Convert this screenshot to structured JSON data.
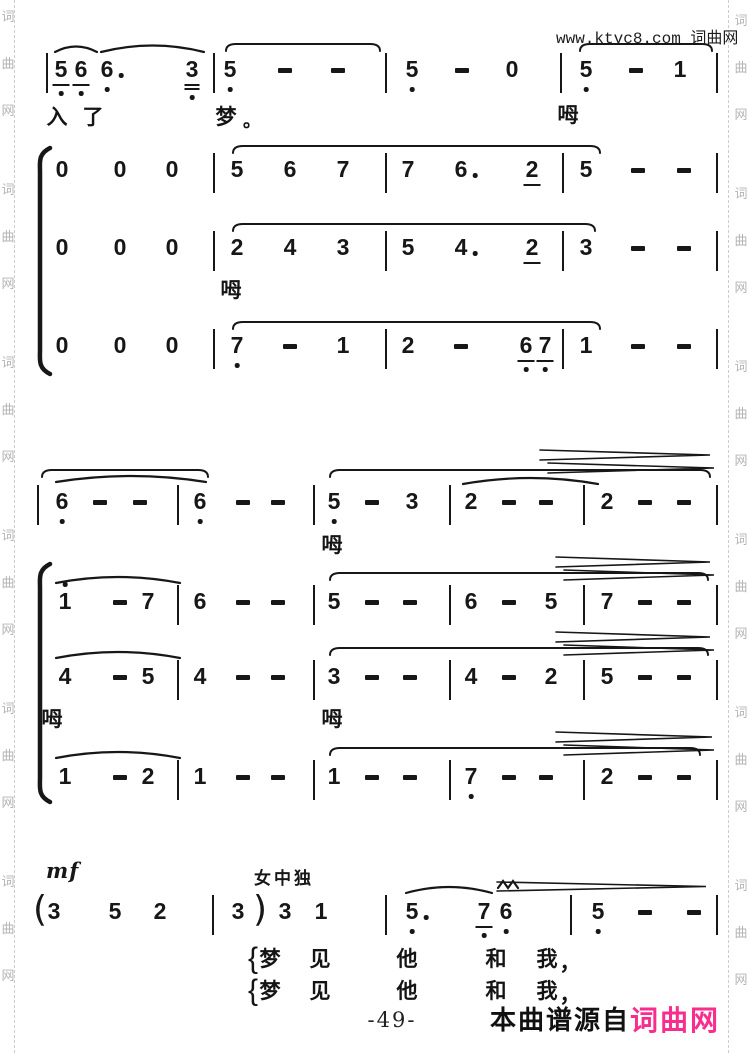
{
  "meta": {
    "watermark_top": "www.ktvc8.com 词曲网",
    "page_number": "-49-",
    "footer_prefix": "本曲谱源自",
    "footer_brand": "词曲网",
    "side_chars": [
      "词",
      "曲",
      "网"
    ],
    "colors": {
      "ink": "#171717",
      "gray_watermark": "#b4b4b4",
      "brand_pink": "#f72e8e",
      "paper": "#ffffff"
    }
  },
  "labels": {
    "mf": "mf",
    "solo": "女中独"
  },
  "score": {
    "rows": [
      {
        "name": "solo-line-1",
        "y": 58,
        "tokens": [
          {
            "t": "|",
            "x": 46
          },
          {
            "t": "5",
            "x": 61,
            "u": 1,
            "lo": 1
          },
          {
            "t": "6",
            "x": 81,
            "u": 1,
            "lo": 1
          },
          {
            "t": "6",
            "x": 107,
            "aug": true,
            "lo": 1
          },
          {
            "t": "3",
            "x": 192,
            "u": 2,
            "lo": 1
          },
          {
            "t": "|",
            "x": 213
          },
          {
            "t": "5",
            "x": 230,
            "lo": 1
          },
          {
            "t": "-",
            "x": 285
          },
          {
            "t": "-",
            "x": 338
          },
          {
            "t": "|",
            "x": 385
          },
          {
            "t": "5",
            "x": 412,
            "lo": 1
          },
          {
            "t": "-",
            "x": 462
          },
          {
            "t": "0",
            "x": 512
          },
          {
            "t": "|",
            "x": 560
          },
          {
            "t": "5",
            "x": 586,
            "lo": 1
          },
          {
            "t": "-",
            "x": 636
          },
          {
            "t": "1",
            "x": 680
          },
          {
            "t": "|",
            "x": 716
          }
        ]
      },
      {
        "name": "choir1-line-1",
        "y": 158,
        "tokens": [
          {
            "t": "0",
            "x": 62
          },
          {
            "t": "0",
            "x": 120
          },
          {
            "t": "0",
            "x": 172
          },
          {
            "t": "|",
            "x": 213
          },
          {
            "t": "5",
            "x": 237
          },
          {
            "t": "6",
            "x": 290
          },
          {
            "t": "7",
            "x": 343
          },
          {
            "t": "|",
            "x": 385
          },
          {
            "t": "7",
            "x": 408
          },
          {
            "t": "6",
            "x": 461,
            "aug": true
          },
          {
            "t": "2",
            "x": 532,
            "u": 1
          },
          {
            "t": "|",
            "x": 562
          },
          {
            "t": "5",
            "x": 586
          },
          {
            "t": "-",
            "x": 638
          },
          {
            "t": "-",
            "x": 684
          },
          {
            "t": "|",
            "x": 716
          }
        ]
      },
      {
        "name": "choir1-line-2",
        "y": 236,
        "tokens": [
          {
            "t": "0",
            "x": 62
          },
          {
            "t": "0",
            "x": 120
          },
          {
            "t": "0",
            "x": 172
          },
          {
            "t": "|",
            "x": 213
          },
          {
            "t": "2",
            "x": 237
          },
          {
            "t": "4",
            "x": 290
          },
          {
            "t": "3",
            "x": 343
          },
          {
            "t": "|",
            "x": 385
          },
          {
            "t": "5",
            "x": 408
          },
          {
            "t": "4",
            "x": 461,
            "aug": true
          },
          {
            "t": "2",
            "x": 532,
            "u": 1
          },
          {
            "t": "|",
            "x": 562
          },
          {
            "t": "3",
            "x": 586
          },
          {
            "t": "-",
            "x": 638
          },
          {
            "t": "-",
            "x": 684
          },
          {
            "t": "|",
            "x": 716
          }
        ]
      },
      {
        "name": "choir1-line-3",
        "y": 334,
        "tokens": [
          {
            "t": "0",
            "x": 62
          },
          {
            "t": "0",
            "x": 120
          },
          {
            "t": "0",
            "x": 172
          },
          {
            "t": "|",
            "x": 213
          },
          {
            "t": "7",
            "x": 237,
            "lo": 1
          },
          {
            "t": "-",
            "x": 290
          },
          {
            "t": "1",
            "x": 343
          },
          {
            "t": "|",
            "x": 385
          },
          {
            "t": "2",
            "x": 408
          },
          {
            "t": "-",
            "x": 461
          },
          {
            "t": "6",
            "x": 526,
            "u": 1,
            "lo": 1
          },
          {
            "t": "7",
            "x": 545,
            "u": 1,
            "lo": 1
          },
          {
            "t": "|",
            "x": 562
          },
          {
            "t": "1",
            "x": 586
          },
          {
            "t": "-",
            "x": 638
          },
          {
            "t": "-",
            "x": 684
          },
          {
            "t": "|",
            "x": 716
          }
        ]
      },
      {
        "name": "solo-line-2",
        "y": 490,
        "tokens": [
          {
            "t": "|",
            "x": 37
          },
          {
            "t": "6",
            "x": 62,
            "lo": 1
          },
          {
            "t": "-",
            "x": 100
          },
          {
            "t": "-",
            "x": 140
          },
          {
            "t": "|",
            "x": 177
          },
          {
            "t": "6",
            "x": 200,
            "lo": 1
          },
          {
            "t": "-",
            "x": 243
          },
          {
            "t": "-",
            "x": 278
          },
          {
            "t": "|",
            "x": 313
          },
          {
            "t": "5",
            "x": 334,
            "lo": 1
          },
          {
            "t": "-",
            "x": 372
          },
          {
            "t": "3",
            "x": 412
          },
          {
            "t": "|",
            "x": 449
          },
          {
            "t": "2",
            "x": 471
          },
          {
            "t": "-",
            "x": 509
          },
          {
            "t": "-",
            "x": 546
          },
          {
            "t": "|",
            "x": 583
          },
          {
            "t": "2",
            "x": 607
          },
          {
            "t": "-",
            "x": 645
          },
          {
            "t": "-",
            "x": 684
          },
          {
            "t": "|",
            "x": 716
          }
        ]
      },
      {
        "name": "choir2-line-1",
        "y": 590,
        "tokens": [
          {
            "t": "1",
            "x": 65,
            "hi": 1
          },
          {
            "t": "-",
            "x": 120
          },
          {
            "t": "7",
            "x": 148
          },
          {
            "t": "|",
            "x": 177
          },
          {
            "t": "6",
            "x": 200
          },
          {
            "t": "-",
            "x": 243
          },
          {
            "t": "-",
            "x": 278
          },
          {
            "t": "|",
            "x": 313
          },
          {
            "t": "5",
            "x": 334
          },
          {
            "t": "-",
            "x": 372
          },
          {
            "t": "-",
            "x": 410
          },
          {
            "t": "|",
            "x": 449
          },
          {
            "t": "6",
            "x": 471
          },
          {
            "t": "-",
            "x": 509
          },
          {
            "t": "5",
            "x": 551
          },
          {
            "t": "|",
            "x": 583
          },
          {
            "t": "7",
            "x": 607
          },
          {
            "t": "-",
            "x": 645
          },
          {
            "t": "-",
            "x": 684
          },
          {
            "t": "|",
            "x": 716
          }
        ]
      },
      {
        "name": "choir2-line-2",
        "y": 665,
        "tokens": [
          {
            "t": "4",
            "x": 65
          },
          {
            "t": "-",
            "x": 120
          },
          {
            "t": "5",
            "x": 148
          },
          {
            "t": "|",
            "x": 177
          },
          {
            "t": "4",
            "x": 200
          },
          {
            "t": "-",
            "x": 243
          },
          {
            "t": "-",
            "x": 278
          },
          {
            "t": "|",
            "x": 313
          },
          {
            "t": "3",
            "x": 334
          },
          {
            "t": "-",
            "x": 372
          },
          {
            "t": "-",
            "x": 410
          },
          {
            "t": "|",
            "x": 449
          },
          {
            "t": "4",
            "x": 471
          },
          {
            "t": "-",
            "x": 509
          },
          {
            "t": "2",
            "x": 551
          },
          {
            "t": "|",
            "x": 583
          },
          {
            "t": "5",
            "x": 607
          },
          {
            "t": "-",
            "x": 645
          },
          {
            "t": "-",
            "x": 684
          },
          {
            "t": "|",
            "x": 716
          }
        ]
      },
      {
        "name": "choir2-line-3",
        "y": 765,
        "tokens": [
          {
            "t": "1",
            "x": 65
          },
          {
            "t": "-",
            "x": 120
          },
          {
            "t": "2",
            "x": 148
          },
          {
            "t": "|",
            "x": 177
          },
          {
            "t": "1",
            "x": 200
          },
          {
            "t": "-",
            "x": 243
          },
          {
            "t": "-",
            "x": 278
          },
          {
            "t": "|",
            "x": 313
          },
          {
            "t": "1",
            "x": 334
          },
          {
            "t": "-",
            "x": 372
          },
          {
            "t": "-",
            "x": 410
          },
          {
            "t": "|",
            "x": 449
          },
          {
            "t": "7",
            "x": 471,
            "lo": 1
          },
          {
            "t": "-",
            "x": 509
          },
          {
            "t": "-",
            "x": 546
          },
          {
            "t": "|",
            "x": 583
          },
          {
            "t": "2",
            "x": 607
          },
          {
            "t": "-",
            "x": 645
          },
          {
            "t": "-",
            "x": 684
          },
          {
            "t": "|",
            "x": 716
          }
        ]
      },
      {
        "name": "alto-solo-line",
        "y": 900,
        "tokens": [
          {
            "t": "(",
            "x": 40
          },
          {
            "t": "3",
            "x": 54
          },
          {
            "t": "5",
            "x": 115
          },
          {
            "t": "2",
            "x": 160
          },
          {
            "t": "|",
            "x": 212
          },
          {
            "t": "3",
            "x": 238
          },
          {
            "t": ")",
            "x": 260
          },
          {
            "t": "3",
            "x": 285
          },
          {
            "t": "1",
            "x": 321
          },
          {
            "t": "|",
            "x": 385
          },
          {
            "t": "5",
            "x": 412,
            "aug": true,
            "lo": 1
          },
          {
            "t": "7",
            "x": 484,
            "u": 1,
            "lo": 1
          },
          {
            "t": "6",
            "x": 506,
            "lo": 1
          },
          {
            "t": "|",
            "x": 570
          },
          {
            "t": "5",
            "x": 598,
            "lo": 1
          },
          {
            "t": "-",
            "x": 645
          },
          {
            "t": "-",
            "x": 694
          },
          {
            "t": "|",
            "x": 716
          }
        ]
      }
    ],
    "lyrics": [
      {
        "t": "入",
        "x": 57,
        "y": 106
      },
      {
        "t": "了",
        "x": 93,
        "y": 106
      },
      {
        "t": "梦",
        "x": 226,
        "y": 106
      },
      {
        "t": "。",
        "x": 252,
        "y": 112,
        "s": 18
      },
      {
        "t": "呣",
        "x": 568,
        "y": 104
      },
      {
        "t": "呣",
        "x": 231,
        "y": 279
      },
      {
        "t": "呣",
        "x": 332,
        "y": 534
      },
      {
        "t": "呣",
        "x": 52,
        "y": 708
      },
      {
        "t": "呣",
        "x": 332,
        "y": 708
      },
      {
        "t": "{",
        "x": 253,
        "y": 942,
        "c": "brk"
      },
      {
        "t": "梦",
        "x": 270,
        "y": 948
      },
      {
        "t": "见",
        "x": 320,
        "y": 948
      },
      {
        "t": "他",
        "x": 407,
        "y": 948
      },
      {
        "t": "和",
        "x": 496,
        "y": 948
      },
      {
        "t": "我",
        "x": 547,
        "y": 948
      },
      {
        "t": "，",
        "x": 570,
        "y": 952
      },
      {
        "t": "{",
        "x": 253,
        "y": 974,
        "c": "brk"
      },
      {
        "t": "梦",
        "x": 270,
        "y": 980
      },
      {
        "t": "见",
        "x": 320,
        "y": 980
      },
      {
        "t": "他",
        "x": 407,
        "y": 980
      },
      {
        "t": "和",
        "x": 496,
        "y": 980
      },
      {
        "t": "我",
        "x": 547,
        "y": 980
      },
      {
        "t": "，",
        "x": 570,
        "y": 984
      }
    ],
    "marks": [
      {
        "k": "arc",
        "x1": 55,
        "x2": 97,
        "y": 52,
        "b": 11
      },
      {
        "k": "arc",
        "x1": 101,
        "x2": 204,
        "y": 52,
        "b": 13
      },
      {
        "k": "flat",
        "x1": 226,
        "x2": 380,
        "y": 44
      },
      {
        "k": "flat",
        "x1": 580,
        "x2": 712,
        "y": 44
      },
      {
        "k": "flat",
        "x1": 233,
        "x2": 600,
        "y": 146
      },
      {
        "k": "flat",
        "x1": 233,
        "x2": 595,
        "y": 224
      },
      {
        "k": "flat",
        "x1": 233,
        "x2": 600,
        "y": 322
      },
      {
        "k": "brace",
        "x": 40,
        "y1": 148,
        "y2": 374
      },
      {
        "k": "flat",
        "x1": 42,
        "x2": 208,
        "y": 470
      },
      {
        "k": "arc",
        "x1": 56,
        "x2": 206,
        "y": 482,
        "b": 12
      },
      {
        "k": "flat",
        "x1": 330,
        "x2": 710,
        "y": 470
      },
      {
        "k": "arc",
        "x1": 463,
        "x2": 598,
        "y": 484,
        "b": 12
      },
      {
        "k": "wedge",
        "x1": 540,
        "x2": 710,
        "y": 450,
        "h": 10
      },
      {
        "k": "wedge",
        "x1": 548,
        "x2": 714,
        "y": 463,
        "h": 10
      },
      {
        "k": "brace",
        "x": 40,
        "y1": 564,
        "y2": 802
      },
      {
        "k": "arc",
        "x1": 56,
        "x2": 180,
        "y": 583,
        "b": 12
      },
      {
        "k": "flat",
        "x1": 330,
        "x2": 708,
        "y": 573
      },
      {
        "k": "wedge",
        "x1": 556,
        "x2": 710,
        "y": 557,
        "h": 10
      },
      {
        "k": "wedge",
        "x1": 564,
        "x2": 714,
        "y": 570,
        "h": 10
      },
      {
        "k": "arc",
        "x1": 56,
        "x2": 180,
        "y": 658,
        "b": 12
      },
      {
        "k": "flat",
        "x1": 330,
        "x2": 708,
        "y": 648
      },
      {
        "k": "wedge",
        "x1": 556,
        "x2": 710,
        "y": 632,
        "h": 10
      },
      {
        "k": "wedge",
        "x1": 564,
        "x2": 714,
        "y": 645,
        "h": 10
      },
      {
        "k": "arc",
        "x1": 56,
        "x2": 180,
        "y": 758,
        "b": 12
      },
      {
        "k": "flat",
        "x1": 330,
        "x2": 700,
        "y": 748
      },
      {
        "k": "wedge",
        "x1": 556,
        "x2": 712,
        "y": 732,
        "h": 10
      },
      {
        "k": "wedge",
        "x1": 564,
        "x2": 714,
        "y": 745,
        "h": 10
      },
      {
        "k": "arc",
        "x1": 406,
        "x2": 492,
        "y": 893,
        "b": 12
      },
      {
        "k": "mord",
        "x": 498,
        "y": 888
      },
      {
        "k": "wedge",
        "x1": 497,
        "x2": 706,
        "y": 882,
        "h": 9
      }
    ]
  }
}
